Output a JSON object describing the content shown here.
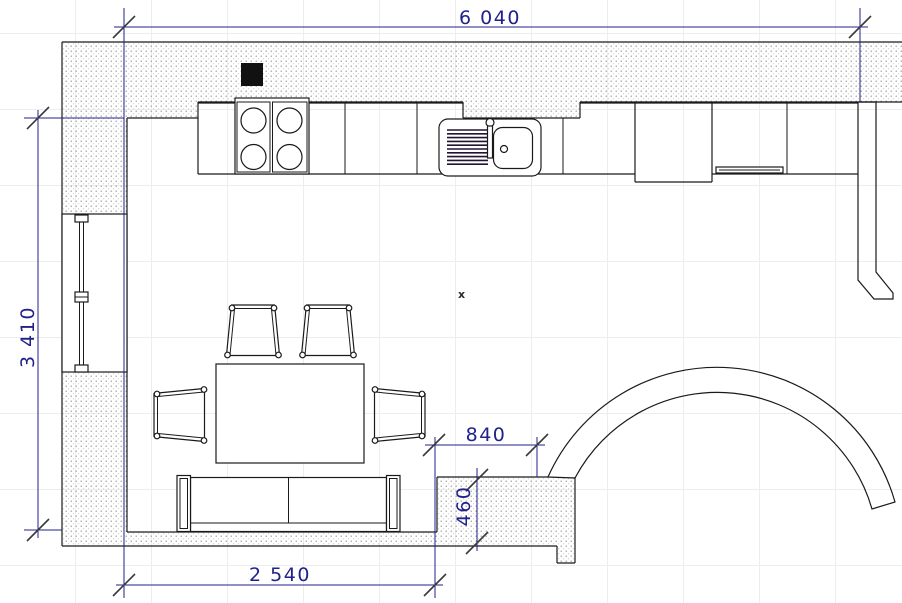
{
  "plan": {
    "dimensions": {
      "total_width": "6 040",
      "total_height": "3 410",
      "sofa_wall_width": "2 540",
      "pier_width": "840",
      "pier_depth": "460"
    },
    "marker": "x",
    "colors": {
      "dimension_text": "#21218c",
      "drawing_line": "#1a1a1a",
      "wall_dot_hatch": "#8f8f8f",
      "background": "#ffffff",
      "grid": "#ededed",
      "hood_fill": "#111111"
    }
  }
}
